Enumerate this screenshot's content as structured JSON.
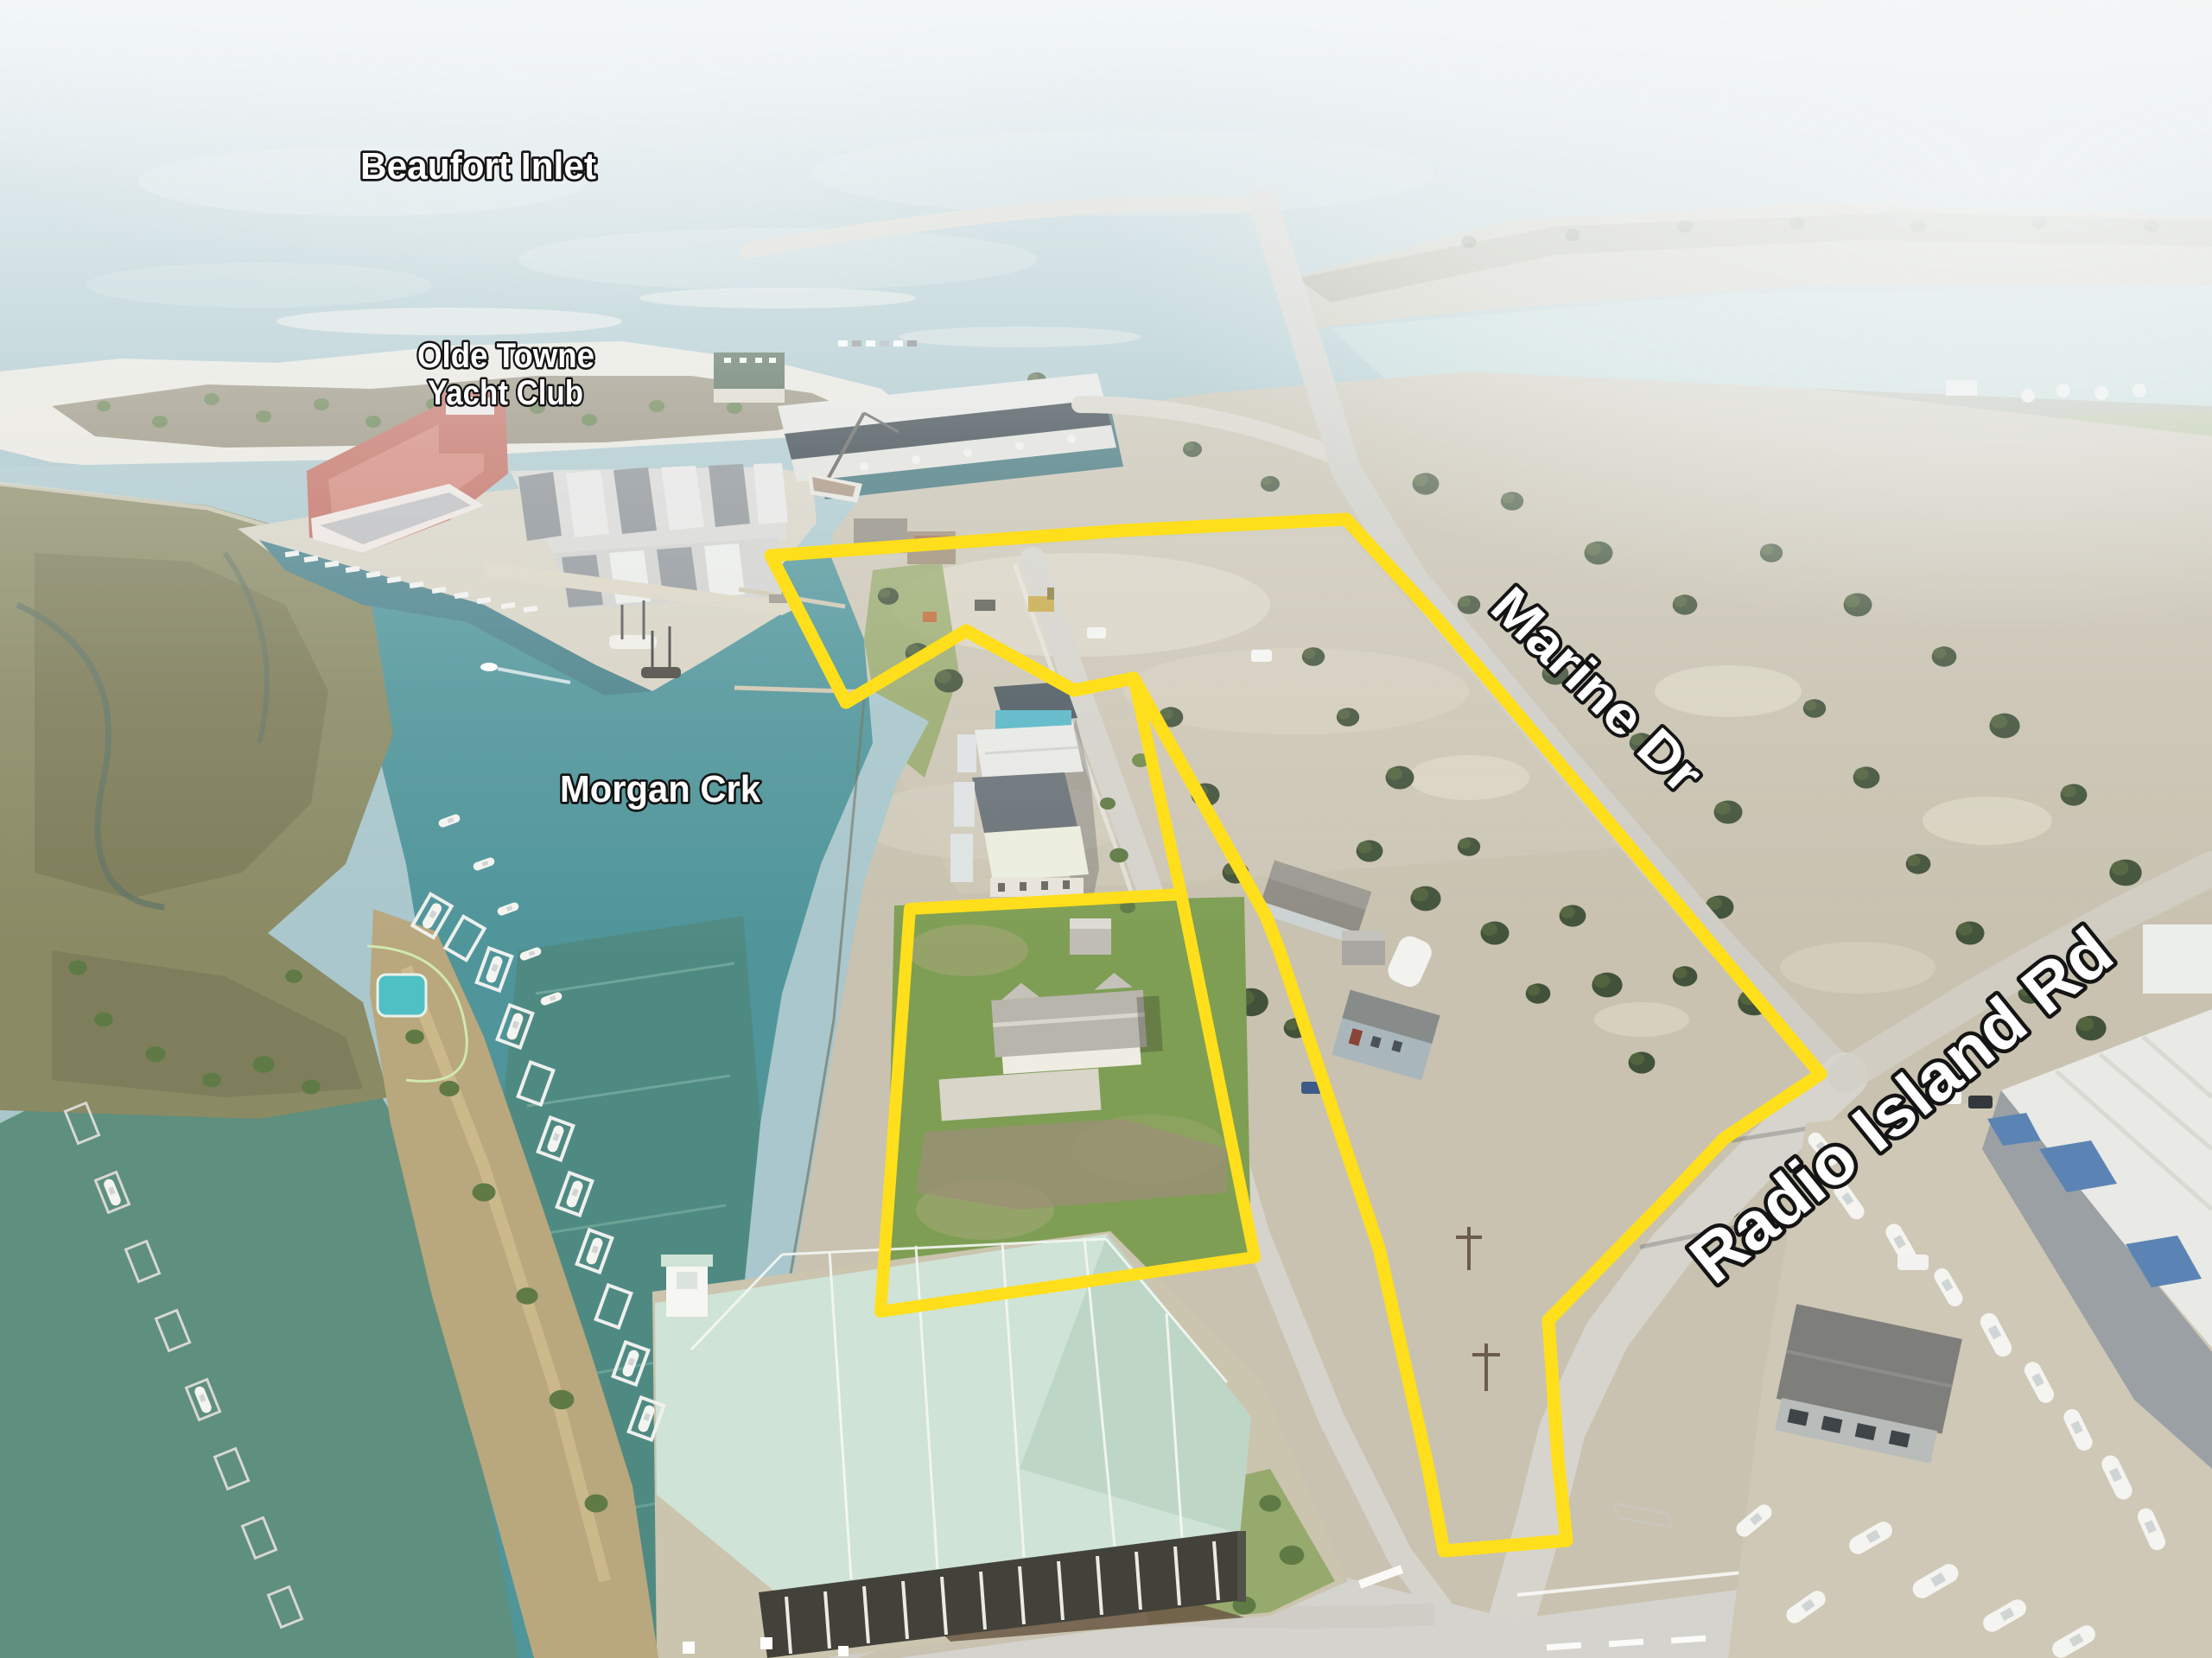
{
  "labels": {
    "beaufort_inlet": "Beaufort Inlet",
    "yacht_club_line1": "Olde Towne",
    "yacht_club_line2": "Yacht Club",
    "morgan_creek": "Morgan Crk",
    "marine_dr": "Marine Dr",
    "radio_island_rd": "Radio Island Rd"
  },
  "boundary": {
    "color": "#ffdf1b",
    "outer_points": "892,643 1300,614 1558,601 1660,712 1886,980 2107,1243 1995,1318 1927,1390 1792,1528 1803,1688 1813,1783 1671,1795 1653,1700 1596,1445 1480,1098 1465,1060 1312,785 1243,799 1118,730 979,813",
    "parcel_points": "1367,1035 1053,1052 1019,1518 1452,1455",
    "spur_points": "1312,785 1367,1035"
  },
  "palette": {
    "water_channel": "#a9c7cc",
    "water_creek": "#4f959a",
    "marsh": "#8a8a64",
    "dirt": "#c9c2b0",
    "road": "#d5d3cb",
    "roof_yacht_club": "#b55a4d",
    "roof_condo": "#cfe3d6",
    "warehouse_blue": "#5b84b4",
    "label_fill": "#ffffff",
    "label_outline": "#141414"
  }
}
